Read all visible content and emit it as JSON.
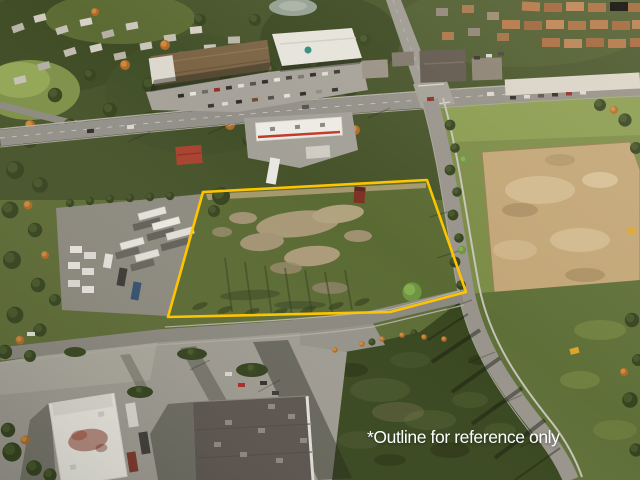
{
  "photo": {
    "annotation": {
      "text": "*Outline for reference only",
      "text_color": "#ffffff"
    },
    "outline_color": "#FFC400"
  }
}
